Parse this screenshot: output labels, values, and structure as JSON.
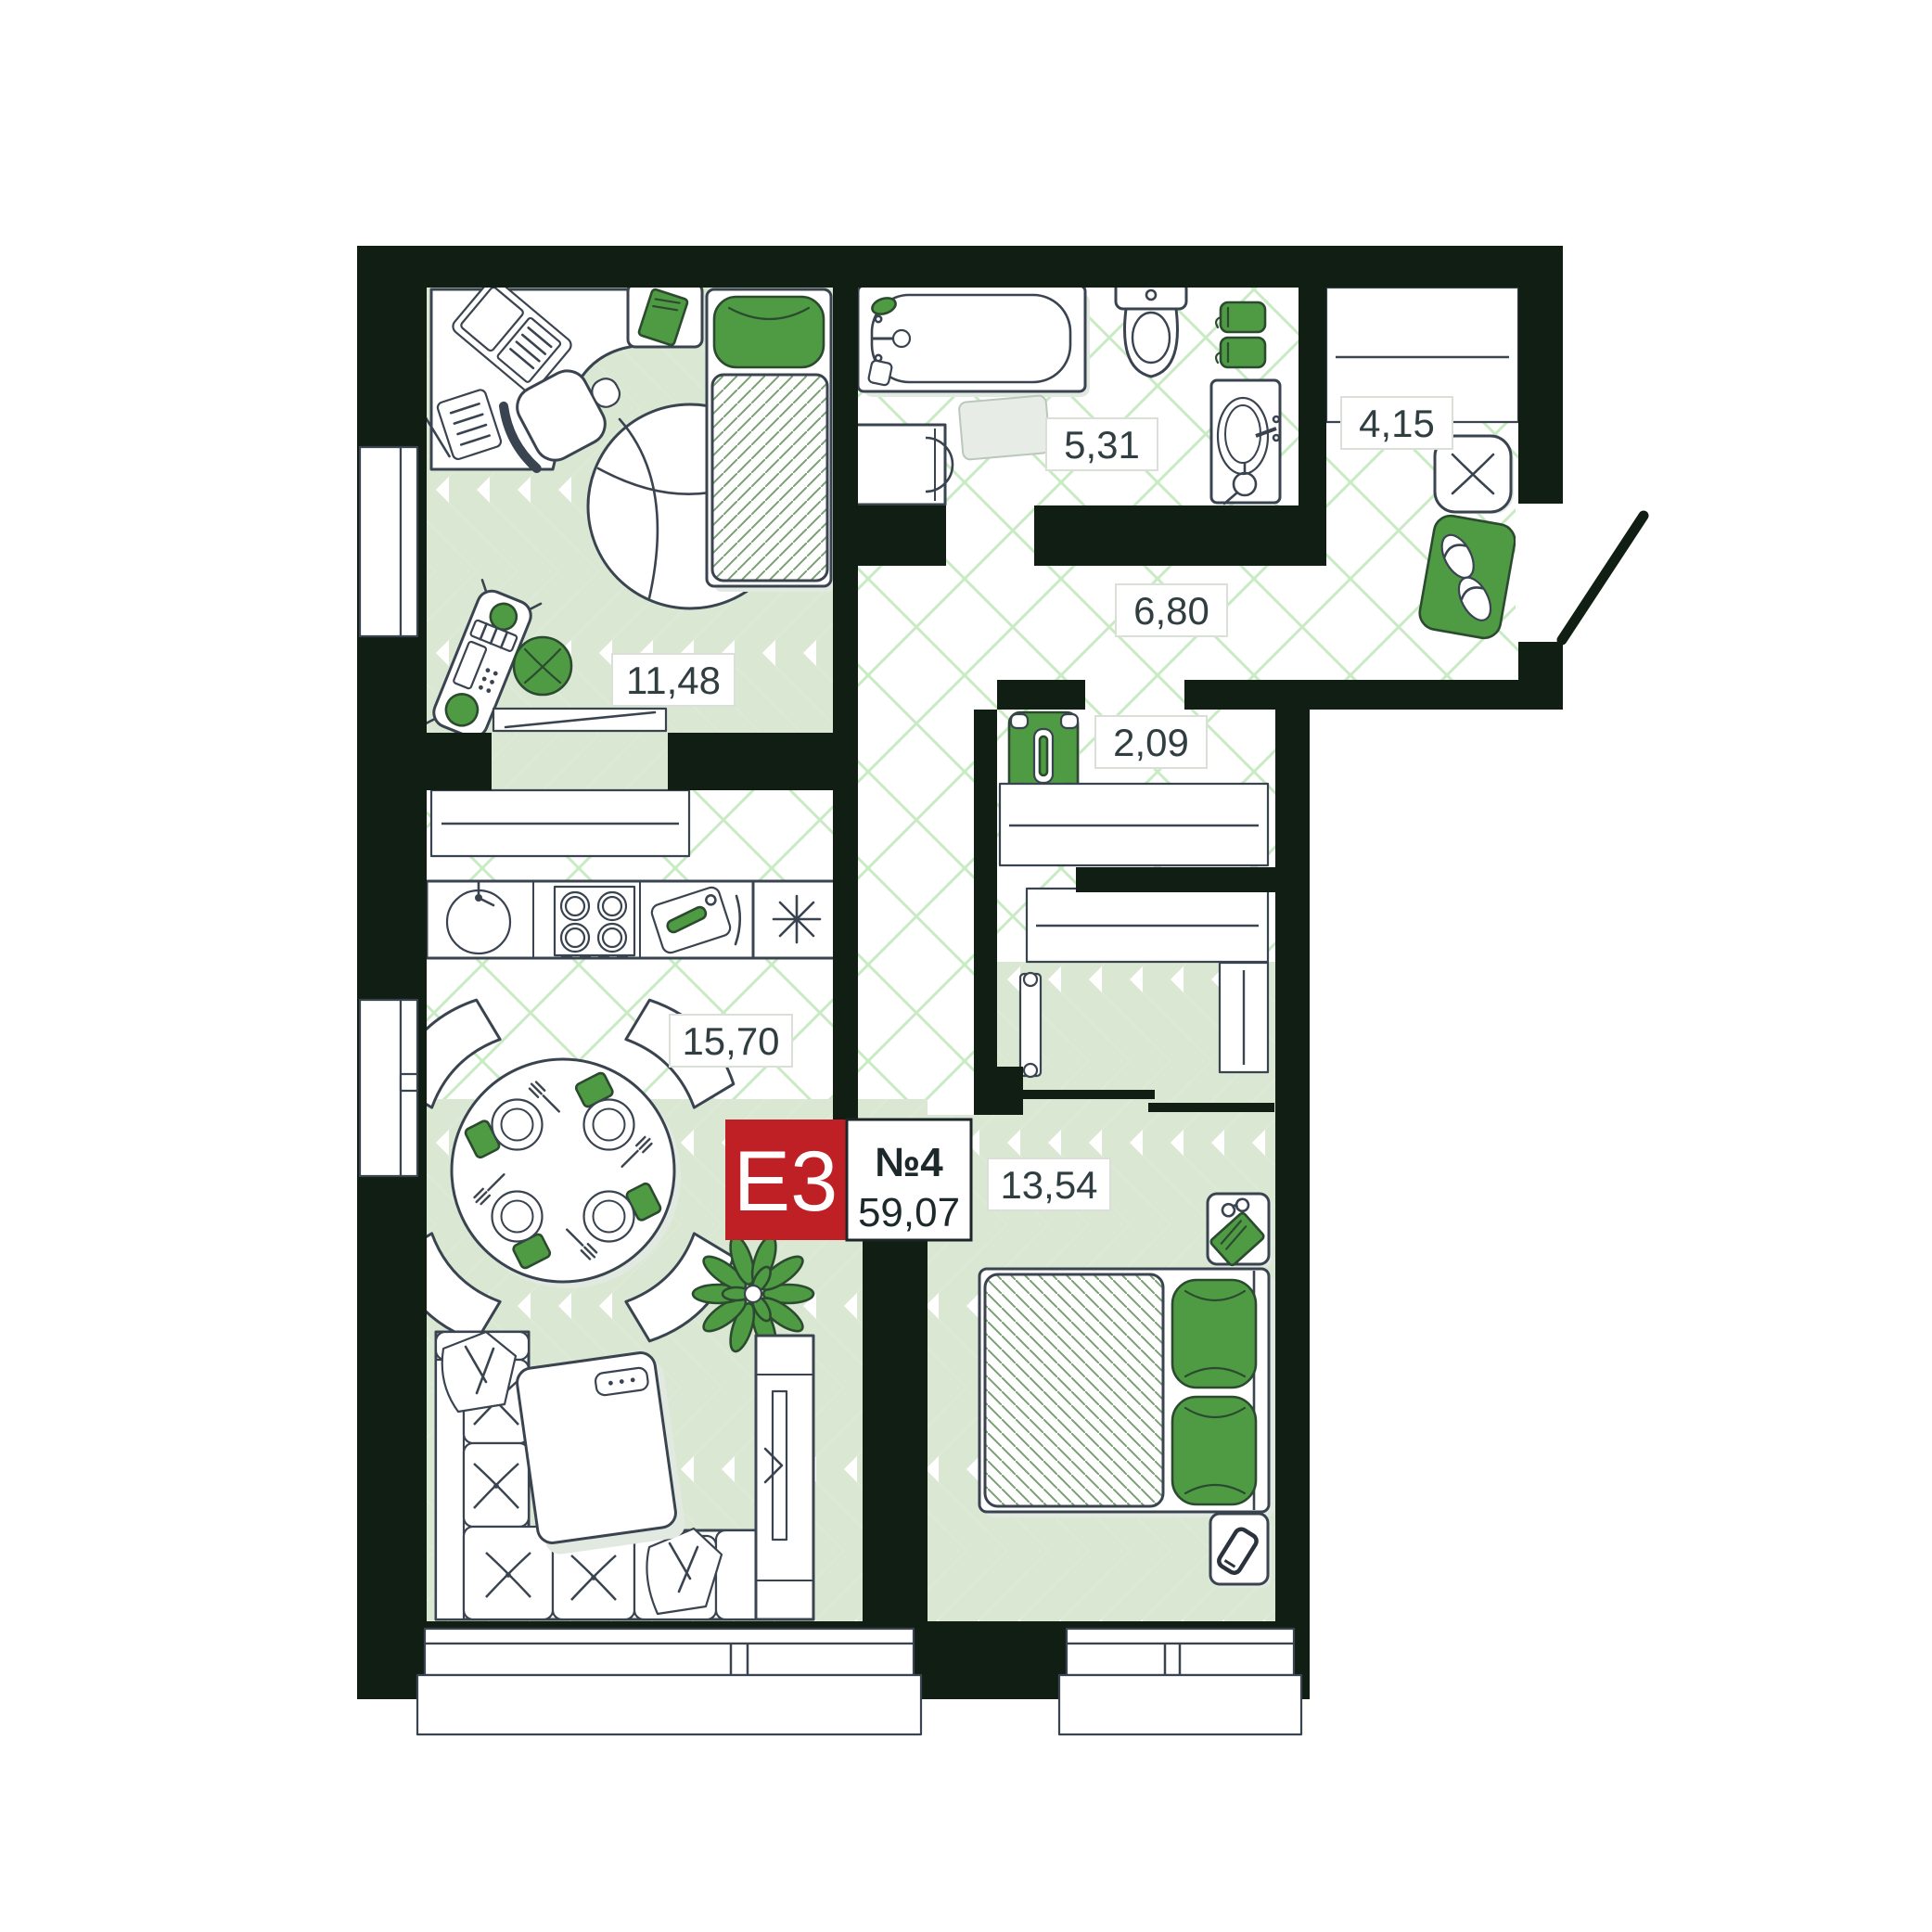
{
  "plan": {
    "unit_badge": {
      "type_label": "E3",
      "unit_number": "№4",
      "total_area": "59,07",
      "badge_color": "#bf2026"
    },
    "rooms": [
      {
        "id": "bedroom-office",
        "area": "11,48"
      },
      {
        "id": "bathroom",
        "area": "5,31"
      },
      {
        "id": "entry-wardrobe",
        "area": "4,15"
      },
      {
        "id": "hallway",
        "area": "6,80"
      },
      {
        "id": "closet",
        "area": "2,09"
      },
      {
        "id": "kitchen-living-room",
        "area": "15,70"
      },
      {
        "id": "bedroom",
        "area": "13,54"
      }
    ],
    "colors": {
      "walls": "#101e13",
      "floor_tile_green": "#d9e7d3",
      "hatch_green": "#c9ebc4",
      "accent_green": "#4e9b44",
      "badge_red": "#bf2026",
      "furniture_line": "#3a4450"
    }
  }
}
